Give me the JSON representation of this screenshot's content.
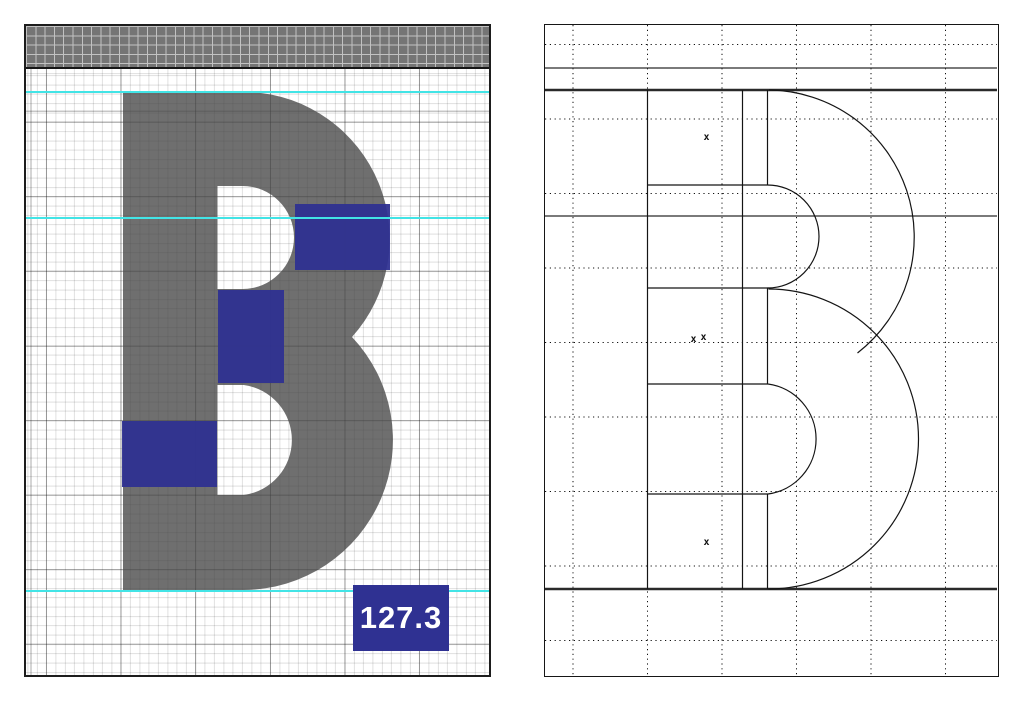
{
  "app": {
    "title": "Glyph editor dual view",
    "glyph_letter": "B"
  },
  "left_panel": {
    "name": "glyph-fill-view",
    "accent_color": "#2f3192",
    "guide_color": "#42e4e6",
    "glyph_color": "#464646",
    "header_bar_color": "#757575",
    "guides_y": [
      65,
      190.5,
      564
    ],
    "overlays": [
      {
        "x": 269,
        "y": 178,
        "w": 95,
        "h": 66
      },
      {
        "x": 192,
        "y": 264,
        "w": 66,
        "h": 93
      },
      {
        "x": 96,
        "y": 395,
        "w": 95,
        "h": 66
      }
    ],
    "badge": {
      "value": "127.3",
      "x": 327,
      "y": 559,
      "w": 96,
      "h": 66
    }
  },
  "right_panel": {
    "name": "glyph-outline-view",
    "line_color": "#141414",
    "dot_grid": {
      "vlines_x": [
        28,
        102.5,
        177,
        251.5,
        326,
        400.5
      ],
      "hlines_y": [
        19.5,
        94,
        168.5,
        243,
        317.5,
        392,
        466.5,
        541,
        615.5
      ]
    },
    "metric_lines_y": [
      43,
      65,
      191,
      564
    ],
    "x_marks": [
      {
        "glyph": "x",
        "x": 161.5,
        "y": 115
      },
      {
        "glyph": "x",
        "x": 148.5,
        "y": 317
      },
      {
        "glyph": "x",
        "x": 158.5,
        "y": 315
      },
      {
        "glyph": "x",
        "x": 161.5,
        "y": 520
      }
    ]
  }
}
